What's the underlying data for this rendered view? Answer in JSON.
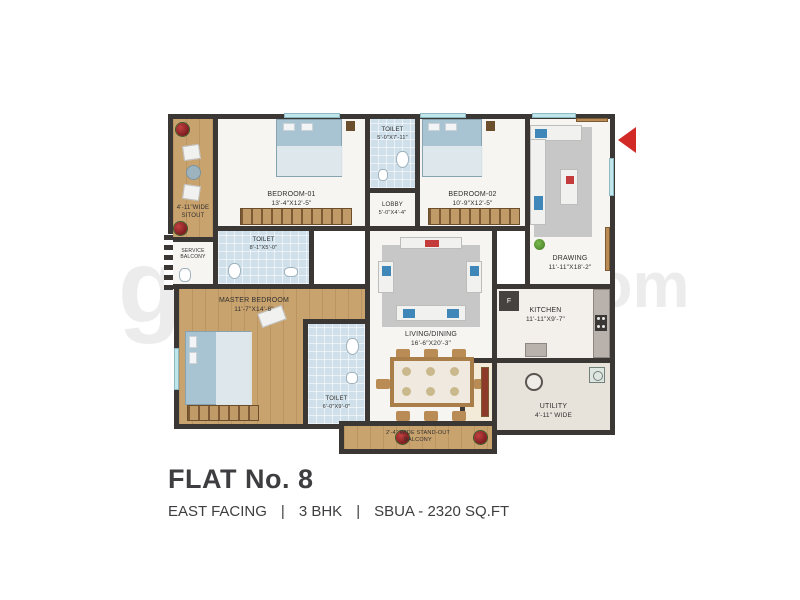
{
  "title_block": {
    "flat_no": "FLAT No. 8",
    "facing": "EAST FACING",
    "sep": "|",
    "bhk": "3 BHK",
    "sbua": "SBUA - 2320 SQ.FT"
  },
  "watermark": {
    "left": "g",
    "right": ".com"
  },
  "colors": {
    "wall": "#3b3735",
    "wood_floor": "#c9a36e",
    "toilet_tile": "#cfe0ea",
    "window": "#bfe6ea",
    "accent_red": "#d22a27",
    "rug_gray": "#c7c7c7",
    "bed_blue": "#a8c3d1"
  },
  "rooms": {
    "sitout": {
      "name": "4'-11\"WIDE",
      "dims": "SITOUT"
    },
    "service_balcony": {
      "name": "SERVICE",
      "dims": "BALCONY"
    },
    "bedroom1": {
      "name": "BEDROOM-01",
      "dims": "13'-4\"X12'-5\""
    },
    "toilet_top": {
      "name": "TOILET",
      "dims": "5'-0\"X7'-11\""
    },
    "lobby": {
      "name": "LOBBY",
      "dims": "5'-0\"X4'-4\""
    },
    "bedroom2": {
      "name": "BEDROOM-02",
      "dims": "10'-9\"X12'-5\""
    },
    "drawing": {
      "name": "DRAWING",
      "dims": "11'-11\"X18'-2\""
    },
    "toilet_mid": {
      "name": "TOILET",
      "dims": "8'-1\"X5'-0\""
    },
    "master": {
      "name": "MASTER BEDROOM",
      "dims": "11'-7\"X14'-6\""
    },
    "toilet_master": {
      "name": "TOILET",
      "dims": "6'-0\"X9'-0\""
    },
    "living": {
      "name": "LIVING/DINING",
      "dims": "16'-6\"X20'-3\""
    },
    "puja": {
      "name": "PUJA"
    },
    "kitchen": {
      "name": "KITCHEN",
      "dims": "11'-11\"X9'-7\""
    },
    "utility": {
      "name": "UTILITY",
      "dims": "4'-11\" WIDE"
    },
    "balcony": {
      "name": "2'-4\" WIDE STAND-OUT",
      "dims": "BALCONY"
    },
    "fridge": {
      "label": "F"
    }
  }
}
